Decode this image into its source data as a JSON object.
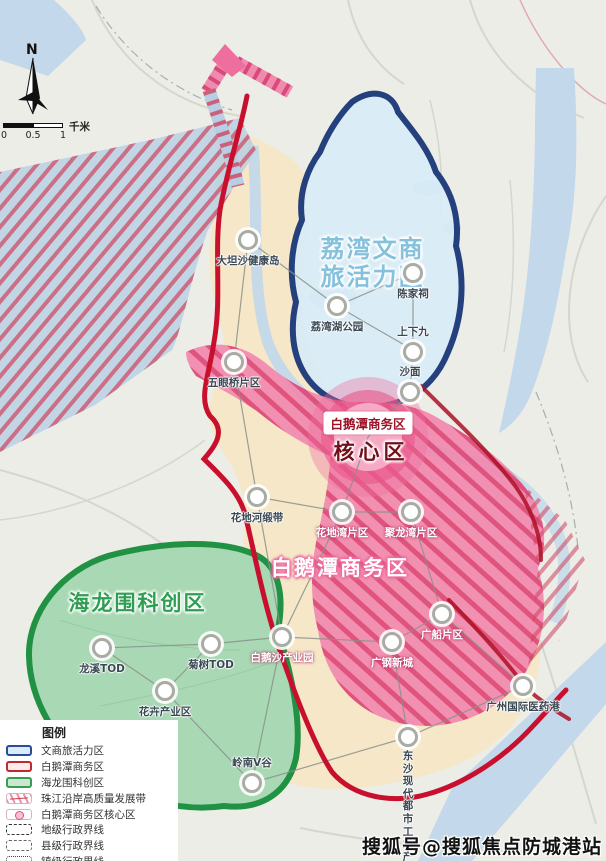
{
  "compass": {
    "north": "N"
  },
  "scalebar": {
    "t0": "0",
    "t05": "0.5",
    "t1": "1",
    "unit": "千米"
  },
  "zones": {
    "liwan": {
      "label": "荔湾文商\n旅活力区"
    },
    "baietan": {
      "label": "白鹅潭商务区"
    },
    "hailongwei": {
      "label": "海龙围科创区"
    },
    "core": {
      "tag": "白鹅潭商务区",
      "label": "核心区"
    }
  },
  "places": [
    {
      "name": "大坦沙健康岛"
    },
    {
      "name": "荔湾湖公园"
    },
    {
      "name": "陈家祠"
    },
    {
      "name": "上下九"
    },
    {
      "name": "沙面"
    },
    {
      "name": "五眼桥片区"
    },
    {
      "name": "花地河缎带"
    },
    {
      "name": "花地湾片区"
    },
    {
      "name": "聚龙湾片区"
    },
    {
      "name": "白鹅沙产业园"
    },
    {
      "name": "广钢新城"
    },
    {
      "name": "广船片区"
    },
    {
      "name": "广州国际医药港"
    },
    {
      "name": "东沙现代都市工\n业产业园"
    },
    {
      "name": "龙溪TOD"
    },
    {
      "name": "菊树TOD"
    },
    {
      "name": "花卉产业区"
    },
    {
      "name": "岭南V谷"
    }
  ],
  "legend": {
    "title": "图例",
    "items": [
      {
        "label": "文商旅活力区"
      },
      {
        "label": "白鹅潭商务区"
      },
      {
        "label": "海龙围科创区"
      },
      {
        "label": "珠江沿岸高质量发展带"
      },
      {
        "label": "白鹅潭商务区核心区"
      },
      {
        "label": "地级行政界线"
      },
      {
        "label": "县级行政界线"
      },
      {
        "label": "镇级行政界线"
      }
    ]
  },
  "watermark": "搜狐号@搜狐焦点防城港站",
  "colors": {
    "blue_zone_border": "#24407d",
    "red_boundary": "#c8102e",
    "green_border": "#219143",
    "pink_zone": "#f184ac",
    "core_ring": "#e9568a",
    "water": "#c3d8ea",
    "land": "#ecede7",
    "plan_area": "#f5e7c8"
  }
}
